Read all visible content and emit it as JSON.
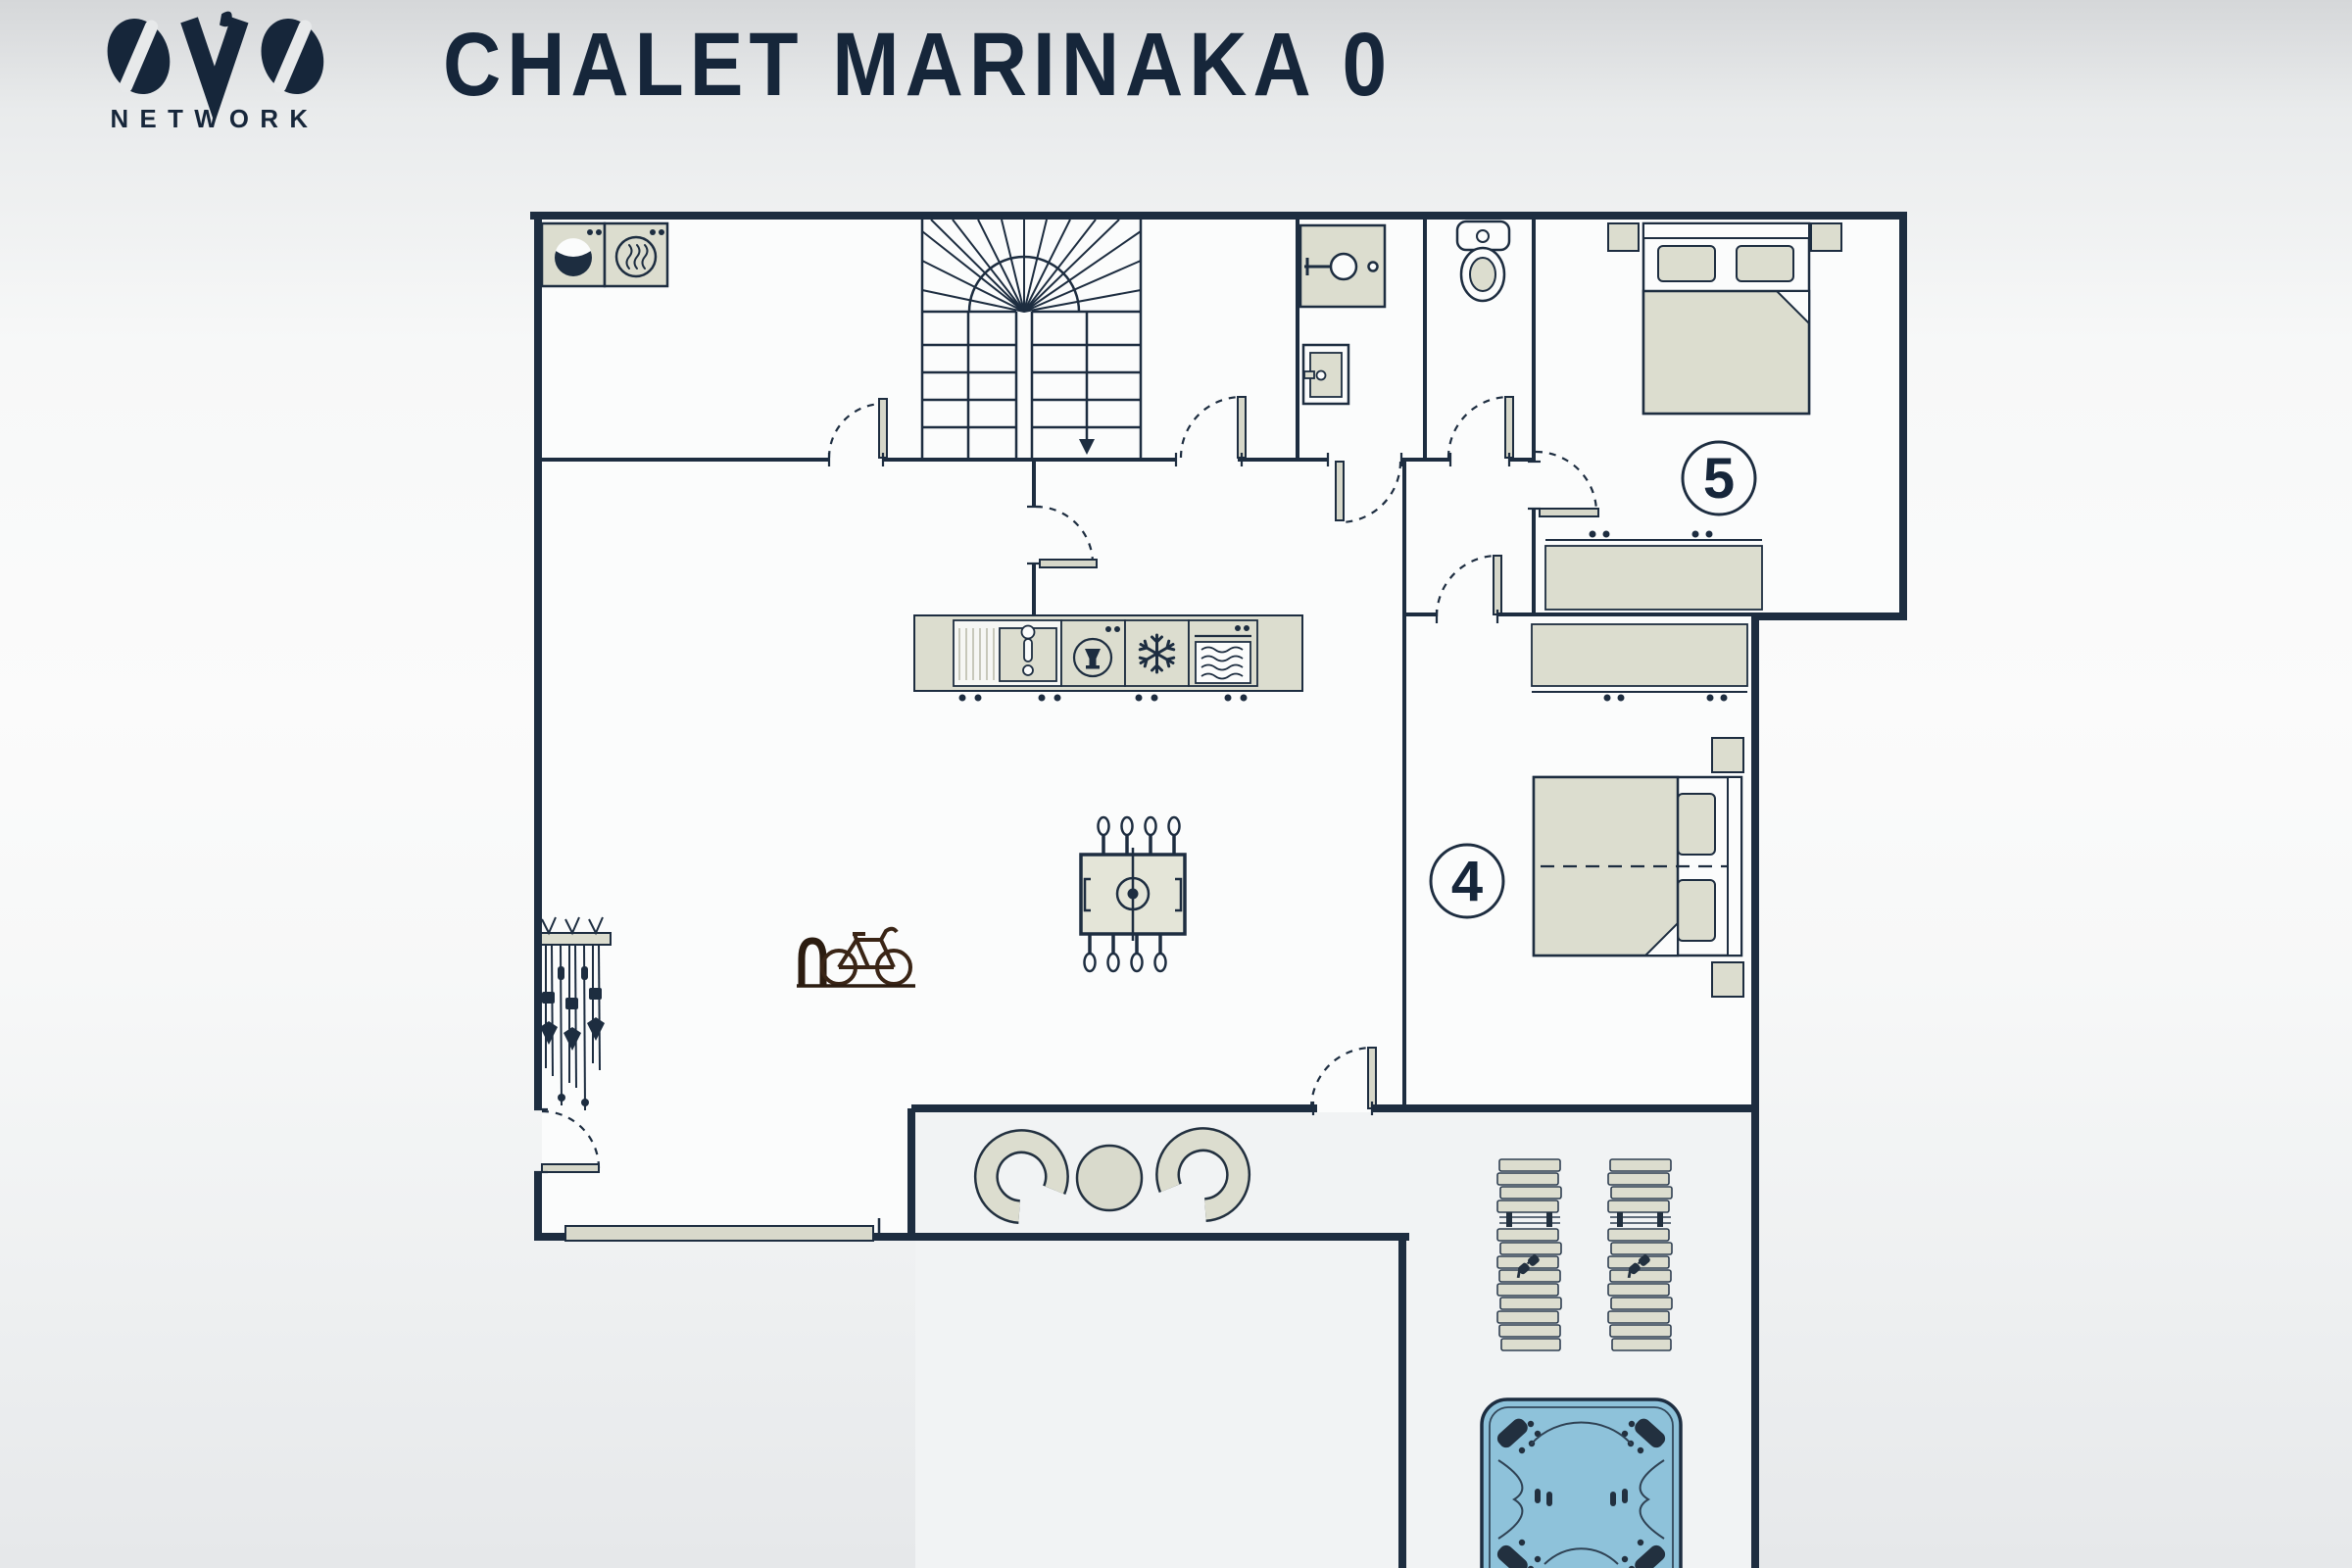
{
  "header": {
    "logo": {
      "brand": "OVO",
      "subtitle": "NETWORK"
    },
    "title": "CHALET MARINAKA 0"
  },
  "floor_plan": {
    "level": "0",
    "rooms": {
      "bedroom_5": {
        "number": "5",
        "features": [
          "double-bed",
          "two-pillows",
          "duvet",
          "two-nightstands",
          "wardrobe"
        ]
      },
      "bedroom_4": {
        "number": "4",
        "features": [
          "double-bed",
          "two-pillows",
          "duvet",
          "two-nightstands",
          "wardrobe"
        ]
      },
      "laundry": {
        "features": [
          "washing-machine",
          "tumble-dryer"
        ]
      },
      "bathroom": {
        "features": [
          "shower",
          "sink"
        ]
      },
      "wc": {
        "features": [
          "toilet"
        ]
      },
      "kitchen": {
        "features": [
          "kitchen-sink",
          "dishwasher",
          "freezer",
          "oven"
        ]
      },
      "living_area": {
        "features": [
          "foosball-table"
        ]
      },
      "boot_room": {
        "features": [
          "ski-rack",
          "bike-rack"
        ]
      },
      "staircase": {
        "direction": "down"
      },
      "covered_terrace": {
        "features": [
          "armchair-left",
          "round-table",
          "armchair-right"
        ]
      },
      "outdoor_terrace": {
        "features": [
          "sun-lounger",
          "sun-lounger",
          "hot-tub"
        ]
      }
    },
    "doors": [
      "laundry-door",
      "bathroom-door",
      "corridor-door",
      "wc-door",
      "bedroom-5-door",
      "bedroom-4-door",
      "entry-door",
      "terrace-door",
      "kitchen-door"
    ],
    "window": "living-room-window",
    "colors": {
      "wall": "#1d2d40",
      "furniture_fill": "#dcddcf",
      "room_fill": "#fbfcfc",
      "terrace_fill": "#f1f3f4",
      "hot_tub_water": "#8ec2da",
      "title_text": "#16263a",
      "bike": "#3a2516"
    }
  }
}
